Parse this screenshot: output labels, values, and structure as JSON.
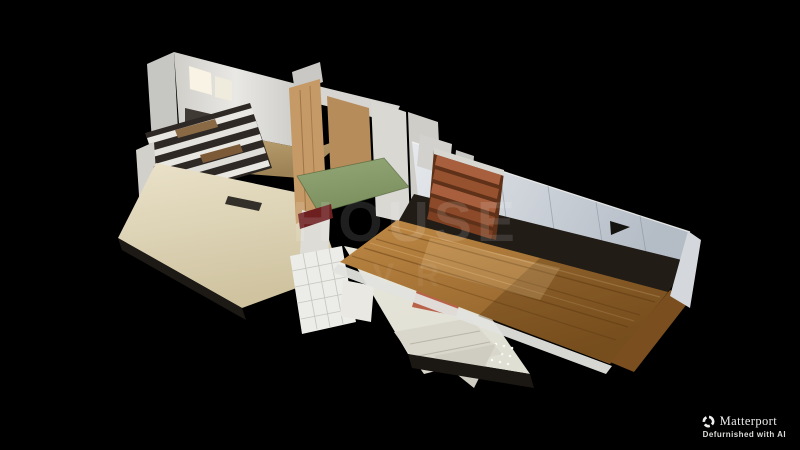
{
  "scene": {
    "type": "matterport-dollhouse-3d-view",
    "description": "Cutaway 3D dollhouse scan of a narrow two-story defurnished house floating on a black background",
    "background": "#000000"
  },
  "watermark": {
    "line1": "HOUSE",
    "line2": "VR"
  },
  "attribution": {
    "brand": "Matterport",
    "tagline": "Defurnished with AI"
  },
  "palette": {
    "background": "#000000",
    "wall_white": "#dcdbd7",
    "wall_blue_grey_light": "#e6e9ec",
    "wall_blue_grey_dark": "#b4bcc6",
    "plywood": "#c59a67",
    "plywood_dark": "#b68c5a",
    "tan_floor_light": "#c9ad7c",
    "tan_floor_dark": "#9c8255",
    "cream_floor_light": "#eae2ca",
    "cream_floor_dark": "#cfc3a0",
    "green_floor": "#94a777",
    "green_floor_dark": "#7b8f5e",
    "red_beam": "#6e2020",
    "stair_wood": "#a85f3e",
    "stair_side": "#5e3118",
    "hardwood_light": "#c08a46",
    "hardwood_dark": "#8a5c26",
    "tile_floor": "#ecece8",
    "terrazzo_floor": "#e0dfd3",
    "window_light": "#f8f3e4",
    "beam_dark": "#2e2925"
  }
}
